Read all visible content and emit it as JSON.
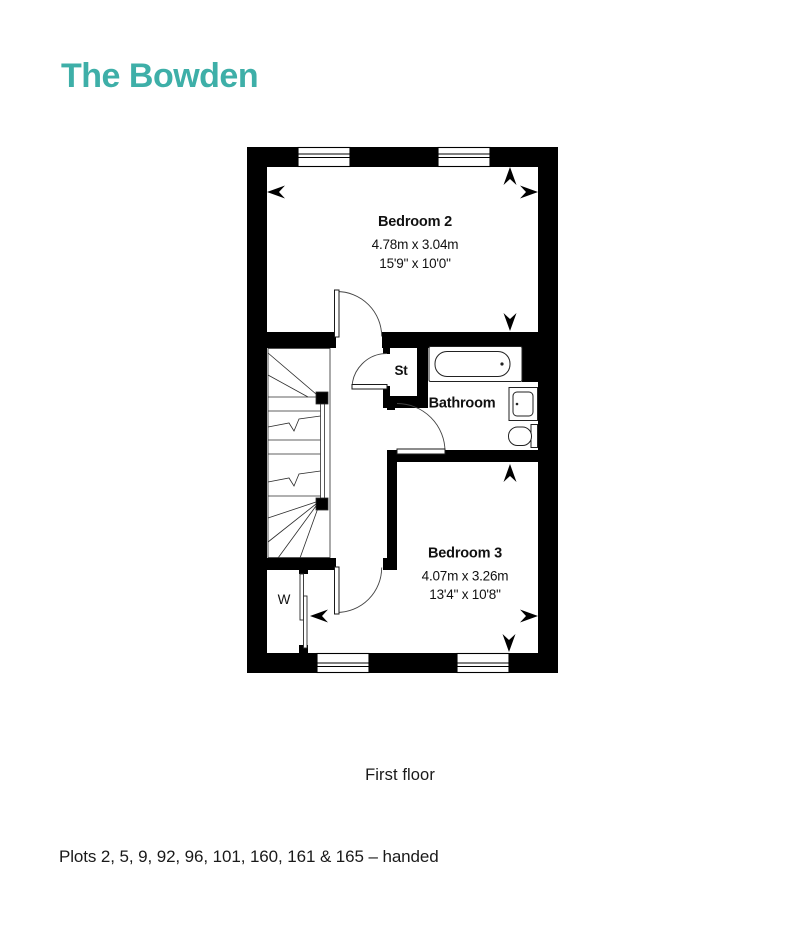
{
  "title": "The Bowden",
  "floor_label": "First floor",
  "plots_note": "Plots 2, 5, 9, 92, 96, 101, 160, 161 & 165 – handed",
  "colors": {
    "accent_teal": "#3EAFA8",
    "wall_black": "#000000",
    "text_dark": "#1A1A1A"
  },
  "plan": {
    "rooms": [
      {
        "name": "Bedroom 2",
        "metric": "4.78m x 3.04m",
        "imperial": "15'9\" x 10'0\""
      },
      {
        "name": "Bedroom 3",
        "metric": "4.07m x 3.26m",
        "imperial": "13'4\" x 10'8\""
      },
      {
        "name": "Bathroom"
      },
      {
        "name": "St"
      },
      {
        "name": "W"
      }
    ],
    "fixtures": [
      "bathtub",
      "sink",
      "toilet",
      "staircase",
      "wardrobe-sliding-doors",
      "windows",
      "doors",
      "dimension-arrows"
    ]
  }
}
